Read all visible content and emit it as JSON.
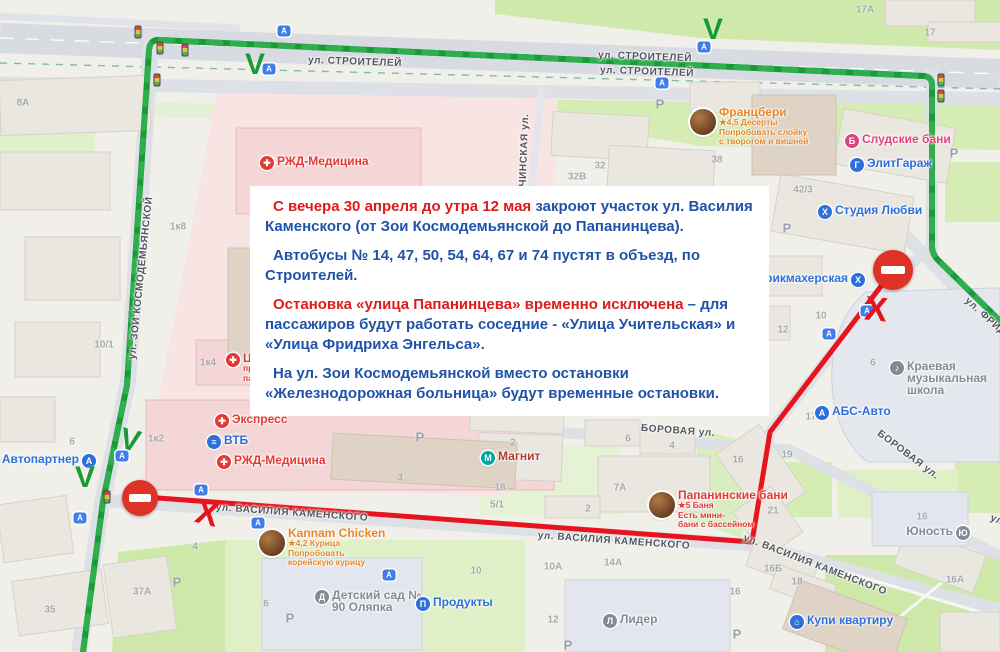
{
  "colors": {
    "route_green": "#189a35",
    "route_green_dash": "#2fae4e",
    "route_red": "#e8131d",
    "sign_red": "#de3226",
    "notice_red": "#e01a1a",
    "notice_blue": "#2053a8",
    "poi_blue": "#2e6fd9",
    "poi_red": "#e23b35",
    "poi_pink": "#e0447c",
    "poi_orange": "#e8872a",
    "poi_gray": "#858b94",
    "poi_darkred": "#b23b32",
    "magnit_teal": "#00a5a5"
  },
  "notice": {
    "paragraphs": [
      {
        "segments": [
          {
            "color": "notice_red",
            "text": "С вечера 30 апреля до утра 12 мая "
          },
          {
            "color": "notice_blue",
            "text": "закроют участок ул. Василия Каменского (от Зои Космодемьянской до Папанинцева)."
          }
        ]
      },
      {
        "segments": [
          {
            "color": "notice_blue",
            "text": "Автобусы № 14, 47, 50, 54, 64, 67 и 74 пустят в объезд, по Строителей."
          }
        ]
      },
      {
        "segments": [
          {
            "color": "notice_red",
            "text": "Остановка «улица Папанинцева» временно исключена"
          },
          {
            "color": "notice_blue",
            "text": " – для пассажиров будут работать соседние - «Улица Учительская» и «Улица Фридриха Энгельса»."
          }
        ]
      },
      {
        "segments": [
          {
            "color": "notice_blue",
            "text": "На ул. Зои Космодемьянской вместо остановки «Железнодорожная больница» будут временные остановки."
          }
        ]
      }
    ]
  },
  "map": {
    "street_labels": [
      {
        "text": "ул. СТРОИТЕЛЕЙ",
        "x": 355,
        "y": 62,
        "rot": 2
      },
      {
        "text": "ул. СТРОИТЕЛЕЙ",
        "x": 645,
        "y": 57,
        "rot": 2
      },
      {
        "text": "ул. СТРОИТЕЛЕЙ",
        "x": 647,
        "y": 72,
        "rot": 2
      },
      {
        "text": "ул. ЗОИ КОСМОДЕМЬЯНСКОЙ",
        "x": 141,
        "y": 278,
        "rot": -84
      },
      {
        "text": "ЕМЯЧИНСКАЯ ул.",
        "x": 524,
        "y": 162,
        "rot": -88
      },
      {
        "text": "ул. ВАСИЛИЯ КАМЕНСКОГО",
        "x": 292,
        "y": 513,
        "rot": 4
      },
      {
        "text": "ул. ВАСИЛИЯ КАМЕНСКОГО",
        "x": 614,
        "y": 541,
        "rot": 4
      },
      {
        "text": "ул. ВАСИЛИЯ КАМЕНСКОГО",
        "x": 815,
        "y": 565,
        "rot": 21
      },
      {
        "text": "ул. ВАСИЛИЯ КАМЕНСКОГО",
        "x": 1062,
        "y": 545,
        "rot": 21
      },
      {
        "text": "БОРОВАЯ ул.",
        "x": 678,
        "y": 431,
        "rot": 4
      },
      {
        "text": "БОРОВАЯ ул.",
        "x": 908,
        "y": 455,
        "rot": 37
      },
      {
        "text": "ул. ФРИДРИХА ЭНГЕЛЬСА",
        "x": 1020,
        "y": 348,
        "rot": 42
      }
    ],
    "building_numbers": [
      [
        865,
        10,
        "17А"
      ],
      [
        930,
        33,
        "17"
      ],
      [
        23,
        103,
        "8А"
      ],
      [
        717,
        160,
        "38"
      ],
      [
        803,
        190,
        "42/3"
      ],
      [
        577,
        177,
        "32В"
      ],
      [
        600,
        166,
        "32"
      ],
      [
        178,
        227,
        "1к8"
      ],
      [
        104,
        345,
        "10/1"
      ],
      [
        208,
        363,
        "1к4"
      ],
      [
        156,
        439,
        "1к2"
      ],
      [
        72,
        442,
        "6"
      ],
      [
        470,
        410,
        "71"
      ],
      [
        513,
        443,
        "2"
      ],
      [
        500,
        488,
        "18"
      ],
      [
        497,
        505,
        "5/1"
      ],
      [
        400,
        478,
        "3"
      ],
      [
        628,
        439,
        "6"
      ],
      [
        672,
        446,
        "4"
      ],
      [
        620,
        488,
        "7А"
      ],
      [
        588,
        509,
        "2"
      ],
      [
        738,
        460,
        "16"
      ],
      [
        787,
        455,
        "19"
      ],
      [
        773,
        511,
        "21"
      ],
      [
        821,
        316,
        "10"
      ],
      [
        783,
        330,
        "12"
      ],
      [
        873,
        363,
        "6"
      ],
      [
        811,
        417,
        "17"
      ],
      [
        922,
        517,
        "16"
      ],
      [
        955,
        580,
        "16А"
      ],
      [
        773,
        569,
        "16Б"
      ],
      [
        797,
        582,
        "18"
      ],
      [
        553,
        567,
        "10А"
      ],
      [
        613,
        563,
        "14А"
      ],
      [
        553,
        620,
        "12"
      ],
      [
        735,
        592,
        "16"
      ],
      [
        266,
        604,
        "6"
      ],
      [
        476,
        571,
        "10"
      ],
      [
        50,
        610,
        "35"
      ],
      [
        142,
        592,
        "37А"
      ],
      [
        195,
        547,
        "4"
      ]
    ],
    "parking_label": "Р",
    "parking_marks": [
      [
        660,
        104
      ],
      [
        954,
        153
      ],
      [
        787,
        228
      ],
      [
        420,
        437
      ],
      [
        177,
        582
      ],
      [
        290,
        618
      ],
      [
        568,
        645
      ],
      [
        737,
        634
      ]
    ],
    "bus_stop_glyph": "А",
    "bus_stops": [
      [
        284,
        31
      ],
      [
        269,
        69
      ],
      [
        704,
        47
      ],
      [
        662,
        83
      ],
      [
        867,
        311
      ],
      [
        829,
        334
      ],
      [
        201,
        490
      ],
      [
        122,
        456
      ],
      [
        80,
        518
      ],
      [
        258,
        523
      ],
      [
        389,
        575
      ]
    ],
    "traffic_lights": [
      [
        138,
        32
      ],
      [
        160,
        48
      ],
      [
        185,
        50
      ],
      [
        157,
        80
      ],
      [
        107,
        497
      ],
      [
        941,
        80
      ],
      [
        941,
        96
      ]
    ],
    "detour_mark_glyph": "V",
    "closed_mark_glyph": "Х",
    "detour_marks": [
      {
        "x": 255,
        "y": 65,
        "rot": 0
      },
      {
        "x": 713,
        "y": 30,
        "rot": 0
      },
      {
        "x": 130,
        "y": 441,
        "rot": 14
      },
      {
        "x": 85,
        "y": 478,
        "rot": 0
      }
    ],
    "closed_marks": [
      {
        "x": 207,
        "y": 514,
        "rot": 14
      },
      {
        "x": 876,
        "y": 310,
        "rot": 6
      }
    ],
    "no_entry_signs": [
      {
        "x": 140,
        "y": 498,
        "d": 36
      },
      {
        "x": 893,
        "y": 270,
        "d": 40
      }
    ],
    "pois": [
      {
        "id": "avtopartner",
        "label": "Автопартнер",
        "x": 89,
        "y": 461,
        "color": "poi_blue",
        "glyph": "А",
        "icon_name": "car-service-icon",
        "side": "left"
      },
      {
        "id": "vtb",
        "label": "ВТБ",
        "x": 214,
        "y": 442,
        "color": "poi_blue",
        "glyph": "≡",
        "icon_name": "bank-icon"
      },
      {
        "id": "express",
        "label": "Экспресс",
        "x": 222,
        "y": 421,
        "color": "poi_red",
        "glyph": "✚",
        "icon_name": "medical-cross-icon"
      },
      {
        "id": "rzd-medicina-top",
        "label": "РЖД-Медицина",
        "x": 267,
        "y": 163,
        "color": "poi_red",
        "glyph": "✚",
        "icon_name": "medical-cross-icon"
      },
      {
        "id": "rzd-medicina-bottom",
        "label": "РЖД-Медицина",
        "x": 224,
        "y": 462,
        "color": "poi_red",
        "glyph": "✚",
        "icon_name": "medical-cross-icon"
      },
      {
        "id": "magnit",
        "label": "Магнит",
        "x": 488,
        "y": 458,
        "color": "poi_darkred",
        "icon_bg": "magnit_teal",
        "glyph": "М",
        "icon_name": "supermarket-icon"
      },
      {
        "id": "francberi",
        "label": "Францбери",
        "x": 703,
        "y": 122,
        "color": "poi_orange",
        "avatar": true,
        "icon_name": "photo-avatar-icon",
        "sub": [
          "★4,5 Десерты",
          "Попробовать слойку",
          "с творогом и вишней"
        ]
      },
      {
        "id": "sludskie-bani",
        "label": "Слудские бани",
        "x": 852,
        "y": 141,
        "color": "poi_pink",
        "glyph": "Б",
        "icon_name": "bathhouse-icon"
      },
      {
        "id": "elitgarazh",
        "label": "ЭлитГараж",
        "x": 857,
        "y": 165,
        "color": "poi_blue",
        "glyph": "Г",
        "icon_name": "garage-icon"
      },
      {
        "id": "studia-lubvi",
        "label": "Студия Любви",
        "x": 825,
        "y": 212,
        "color": "poi_blue",
        "glyph": "Х",
        "icon_name": "studio-icon"
      },
      {
        "id": "parikmakherskaya",
        "label": "Парикмахерская",
        "x": 858,
        "y": 280,
        "color": "poi_blue",
        "glyph": "Х",
        "icon_name": "hairdresser-icon",
        "side": "left"
      },
      {
        "id": "music-school",
        "label": "Краевая музыкальная школа",
        "x": 897,
        "y": 368,
        "color": "poi_gray",
        "glyph": "♪",
        "icon_name": "music-school-icon",
        "maxw": 92
      },
      {
        "id": "abs-avto",
        "label": "АБС-Авто",
        "x": 822,
        "y": 413,
        "color": "poi_blue",
        "glyph": "А",
        "icon_name": "car-service-icon"
      },
      {
        "id": "yunost",
        "label": "Юность",
        "x": 963,
        "y": 533,
        "color": "poi_gray",
        "glyph": "Ю",
        "icon_name": "sport-icon",
        "side": "left"
      },
      {
        "id": "papaninskie-bani",
        "label": "Папанинские бани",
        "x": 662,
        "y": 505,
        "color": "poi_red",
        "avatar": true,
        "icon_name": "photo-avatar-icon",
        "sub": [
          "★5 Баня",
          "Есть мини-",
          "бани с бассейном"
        ]
      },
      {
        "id": "kannam-chicken",
        "label": "Kannam Chicken",
        "x": 272,
        "y": 543,
        "color": "poi_orange",
        "avatar": true,
        "icon_name": "photo-avatar-icon",
        "sub": [
          "★4,2 Курица",
          "Попробовать",
          "корейскую курицу"
        ]
      },
      {
        "id": "detsad-olyapka",
        "label": "Детский сад № 90 Оляпка",
        "x": 322,
        "y": 597,
        "color": "poi_gray",
        "glyph": "Д",
        "icon_name": "kindergarten-icon",
        "maxw": 95
      },
      {
        "id": "produkty",
        "label": "Продукты",
        "x": 423,
        "y": 604,
        "color": "poi_blue",
        "glyph": "П",
        "icon_name": "grocery-icon"
      },
      {
        "id": "lider",
        "label": "Лидер",
        "x": 610,
        "y": 621,
        "color": "poi_gray",
        "glyph": "Л",
        "icon_name": "school-icon"
      },
      {
        "id": "kupi-kvartiru",
        "label": "Купи квартиру",
        "x": 797,
        "y": 622,
        "color": "poi_blue",
        "glyph": "⌂",
        "icon_name": "real-estate-icon"
      },
      {
        "id": "med-center-fragment",
        "label": "Цен",
        "x": 233,
        "y": 360,
        "color": "poi_red",
        "glyph": "✚",
        "icon_name": "medical-cross-icon",
        "sub": [
          "про",
          "пато"
        ],
        "z": 5
      }
    ]
  }
}
